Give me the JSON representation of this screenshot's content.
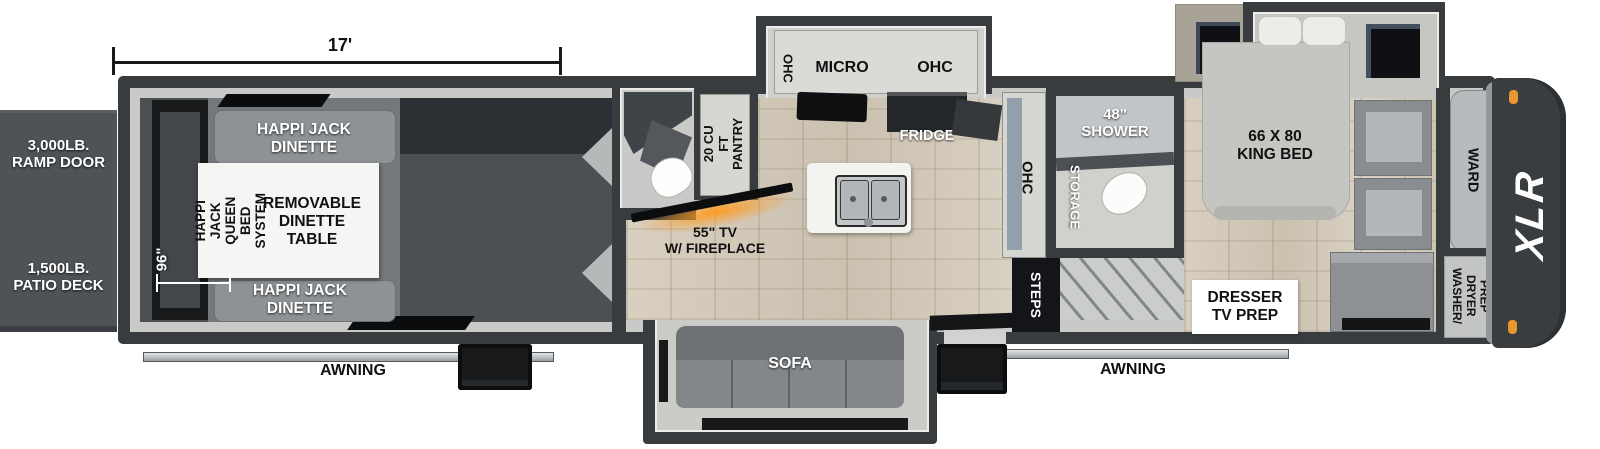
{
  "brand": "XLR",
  "colors": {
    "wall": "#383c3f",
    "interior_lining": "#c9c9c7",
    "garage_floor": "#4b5053",
    "wood_floor": "#d3cabb",
    "deck": "#4e5358",
    "fireplace_glow": "#ff9a1e",
    "marker_light_orange": "#e8962e"
  },
  "dimensions": {
    "garage_length": "17'",
    "garage_width": "96\""
  },
  "exterior": {
    "ramp_door": "3,000LB.\nRAMP DOOR",
    "patio_deck": "1,500LB.\nPATIO DECK",
    "awning_left": "AWNING",
    "awning_right": "AWNING",
    "brand_logo": "XLR"
  },
  "garage": {
    "dinette_top": "HAPPI JACK\nDINETTE",
    "dinette_bottom": "HAPPI JACK\nDINETTE",
    "queen_bed_system": "HAPPI JACK\nQUEEN BED\nSYSTEM",
    "removable_table": "REMOVABLE\nDINETTE\nTABLE"
  },
  "kitchen": {
    "ohc_left": "OHC",
    "micro": "MICRO",
    "ohc_right": "OHC",
    "fridge": "FRIDGE",
    "pantry": "20 CU FT\nPANTRY",
    "ohc_tall": "OHC"
  },
  "living": {
    "tv_fireplace": "55\" TV\nW/ FIREPLACE",
    "sofa": "SOFA",
    "steps": "STEPS"
  },
  "bath": {
    "shower": "48\"\nSHOWER",
    "storage": "STORAGE"
  },
  "bedroom": {
    "king_bed": "66 X 80\nKING BED",
    "ward": "WARD",
    "dresser": "DRESSER\nTV PREP",
    "washer_dryer": "WASHER/\nDRYER\nPREP"
  }
}
